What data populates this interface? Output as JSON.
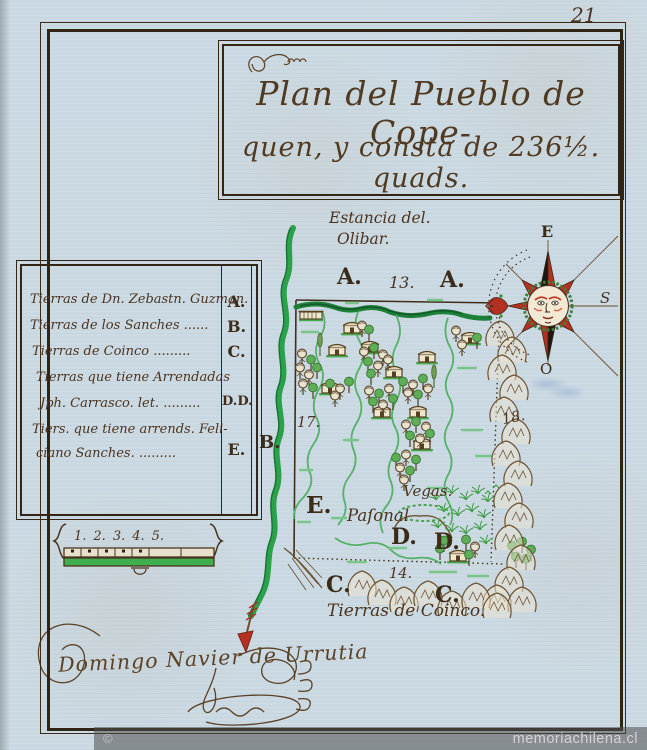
{
  "page": {
    "number": "21",
    "title_line1": "Plan del Pueblo de Cope-",
    "title_line2": "quen, y consta de 236½. quads."
  },
  "legend": {
    "rows": [
      {
        "text": "Tierras de Dn. Zebastn. Guzman."
      },
      {
        "text": "Tierras de los Sanches ......"
      },
      {
        "text": "Tierras de Coinco ........."
      },
      {
        "text": "Tierras que tiene Arrendadas"
      },
      {
        "text": "Jph. Carrasco. let. ........."
      },
      {
        "text": "Tiers. que tiene arrends. Feli-"
      },
      {
        "text": "ciano Sanches. ........."
      }
    ],
    "letters": [
      {
        "label": "A."
      },
      {
        "label": "B."
      },
      {
        "label": "C."
      },
      {
        "label": "D.D."
      },
      {
        "label": "E."
      }
    ]
  },
  "labels": {
    "estancia1": "Estancia del.",
    "estancia2": "Olibar.",
    "a_left": "A.",
    "n13": "13.",
    "a_right": "A.",
    "n17": "17.",
    "n18": "18.",
    "b_outside": "B.",
    "e": "E.",
    "pajonal": "Paſonal",
    "vegas": "Vegas.",
    "d1": "D.",
    "d2": "D.",
    "n14": "14.",
    "c1": "C.",
    "c2": "C.",
    "coinco": "Tierras de Coinco."
  },
  "compass": {
    "top": "E",
    "right": "S",
    "bottom": "O"
  },
  "scale": {
    "numbers": [
      "1.",
      "2.",
      "3.",
      "4.",
      "5."
    ]
  },
  "signature": "Domingo Navier de Urrutia",
  "watermark": {
    "copyright": "©",
    "site": "memoriachilena.cl"
  },
  "colors": {
    "paper": "#ccdae3",
    "ink": "#4a3420",
    "river_green": "#27a246",
    "accent_red": "#b43022"
  }
}
